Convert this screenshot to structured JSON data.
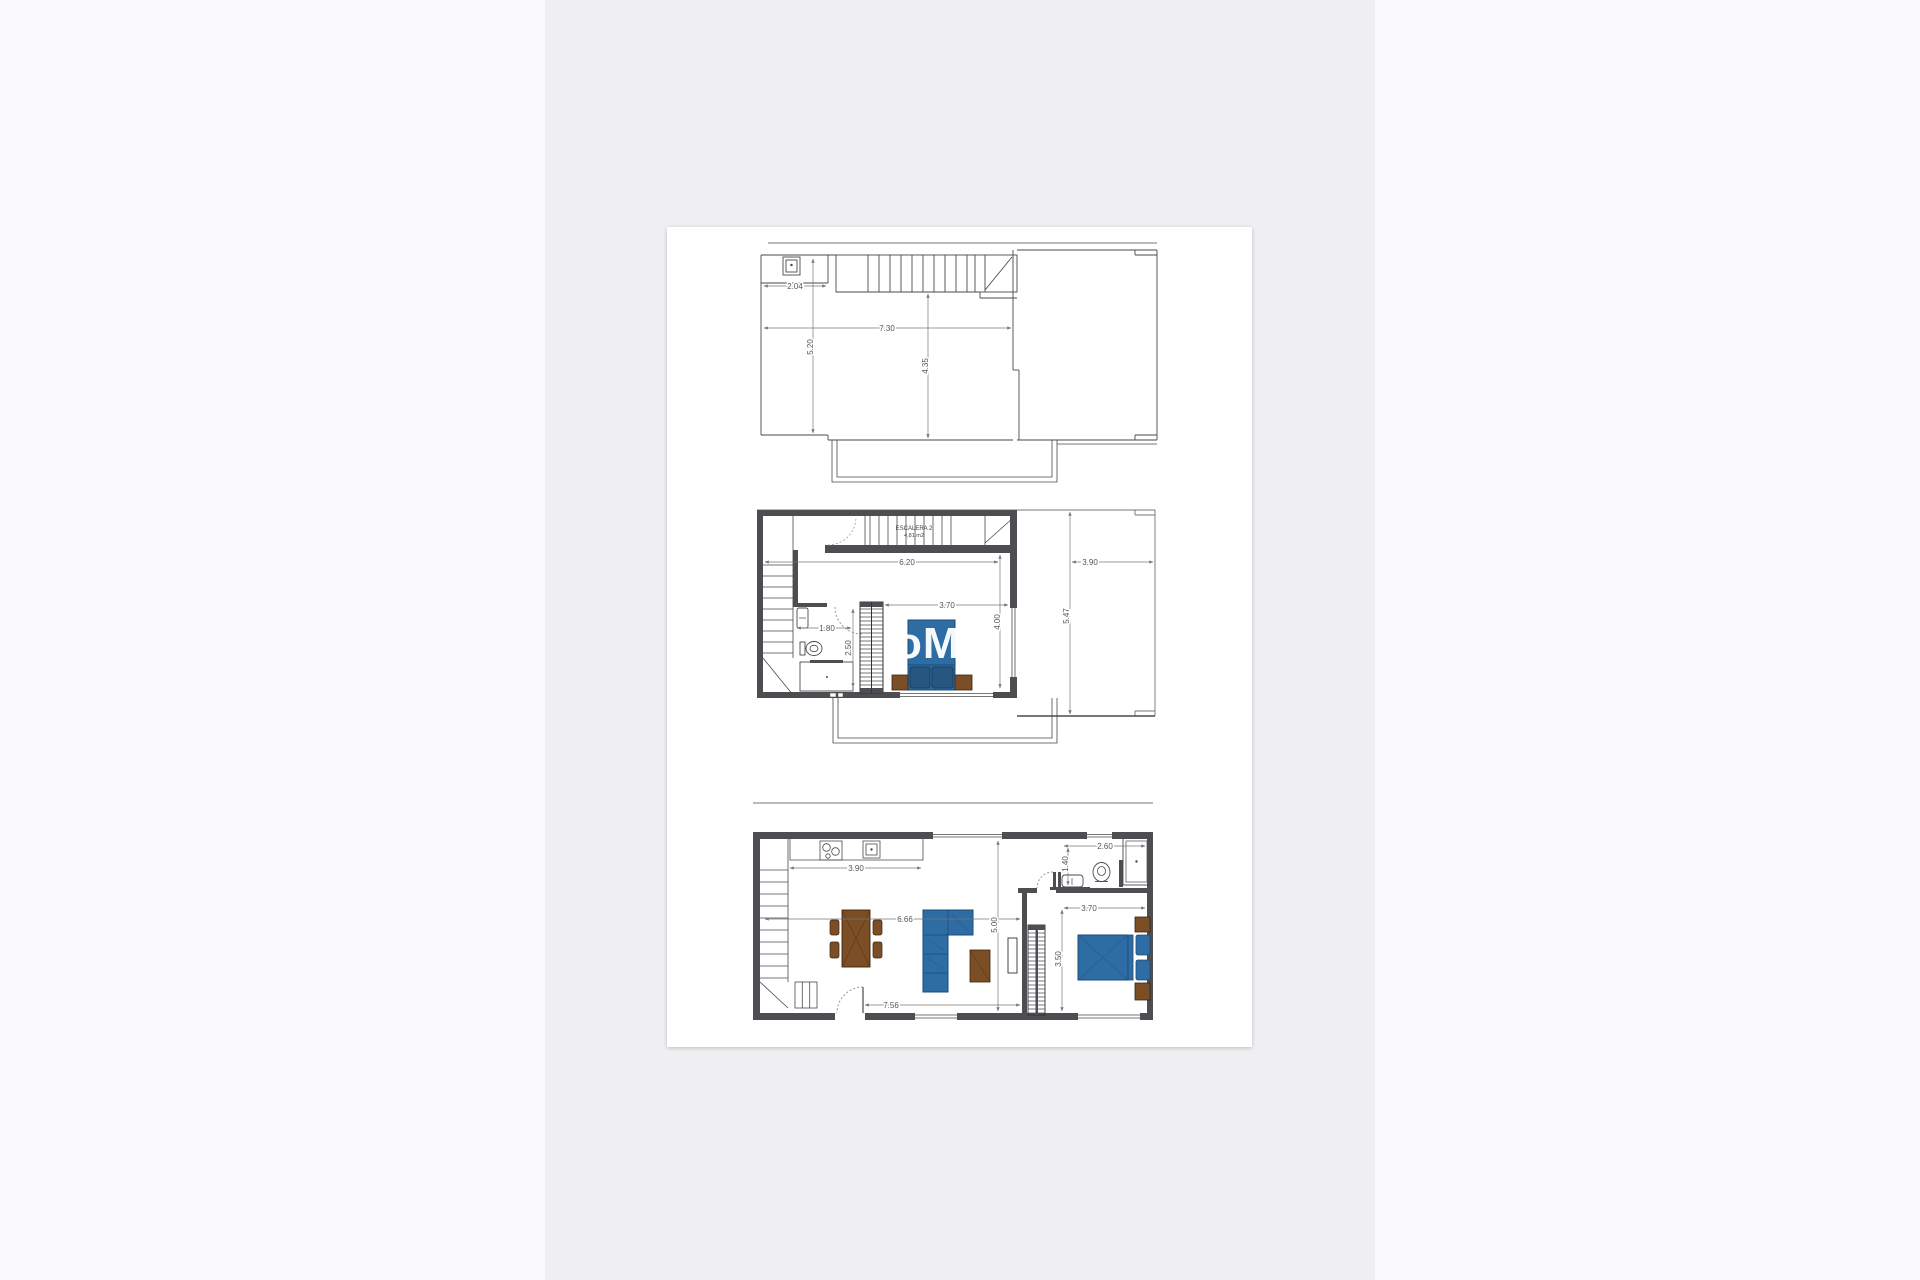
{
  "watermark": {
    "text": "oMo"
  },
  "plans": {
    "roof": {
      "dims": {
        "w204": "2.04",
        "w730": "7.30",
        "h520": "5.20",
        "h435": "4.35"
      }
    },
    "first": {
      "stair_label": "ESCALERA 2",
      "stair_area": "4,81 m2",
      "dims": {
        "w620": "6.20",
        "w390": "3.90",
        "w370": "3.70",
        "w180": "1.80",
        "h250": "2.50",
        "h400": "4.00",
        "h547": "5.47"
      }
    },
    "ground": {
      "dims": {
        "w390": "3.90",
        "w666": "6.66",
        "w756": "7.56",
        "h500": "5.00",
        "w260": "2.60",
        "h140": "1.40",
        "w370": "3.70",
        "h350": "3.50"
      }
    }
  },
  "colors": {
    "page_bg": "#fbfbfd",
    "band_bg": "#f0f0f3",
    "card_bg": "#ffffff",
    "wall": "#4e4e52",
    "line": "#4a4a4a",
    "dim_line": "#777777",
    "furniture_blue": "#2e6da4",
    "furniture_blue_dark": "#1b4b77",
    "pillow_blue": "#27577f",
    "furniture_brown": "#7c4e25",
    "watermark_color": "#ffffff"
  }
}
